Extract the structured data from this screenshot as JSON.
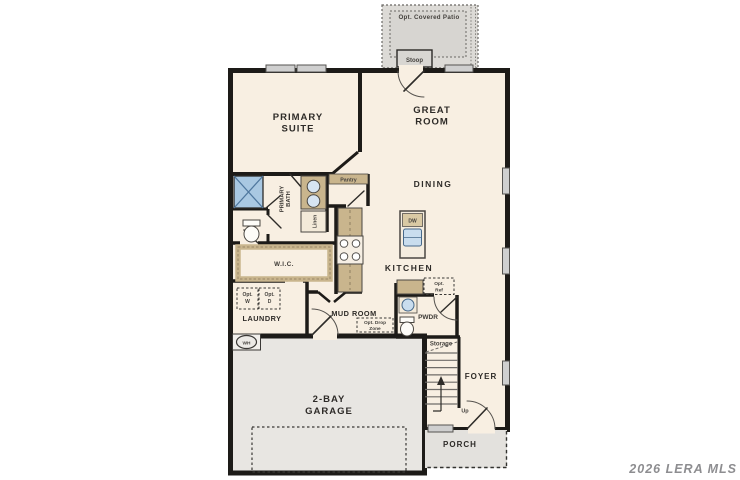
{
  "watermark": {
    "text": "2026 LERA MLS"
  },
  "colors": {
    "walls": "#1d1b18",
    "living_floor": "#f8efe2",
    "garage_floor": "#e8e6e2",
    "porch_floor": "#e3e1dd",
    "patio_floor": "#dcdad6",
    "cabinet_tan": "#c9b58d",
    "fixture_blue": "#bad3e8",
    "shower_blue": "#a9c8e2",
    "window_gray": "#cfcfcf"
  },
  "plan": {
    "outdoor": {
      "patio_label": "Opt. Covered Patio",
      "stoop_label": "Stoop",
      "porch_label": "PORCH"
    },
    "rooms": {
      "primary_suite": [
        "PRIMARY",
        "SUITE"
      ],
      "great_room": [
        "GREAT",
        "ROOM"
      ],
      "dining": "DINING",
      "kitchen": "KITCHEN",
      "primary_bath": [
        "PRIMARY",
        "BATH"
      ],
      "pantry": "Pantry",
      "linen": "Linen",
      "wic": "W.I.C.",
      "laundry": "LAUNDRY",
      "mud_room": "MUD ROOM",
      "pwdr": "PWDR",
      "storage": "Storage",
      "foyer": "FOYER",
      "garage": [
        "2-BAY",
        "GARAGE"
      ],
      "up_label": "Up"
    },
    "fixtures": {
      "water_heater": "WH",
      "dishwasher": "DW",
      "opt_washer": [
        "Opt.",
        "W"
      ],
      "opt_dryer": [
        "Opt.",
        "D"
      ],
      "opt_drop_zone": [
        "Opt. Drop",
        "Zone"
      ],
      "opt_ref": [
        "Opt.",
        "Ref"
      ]
    }
  }
}
